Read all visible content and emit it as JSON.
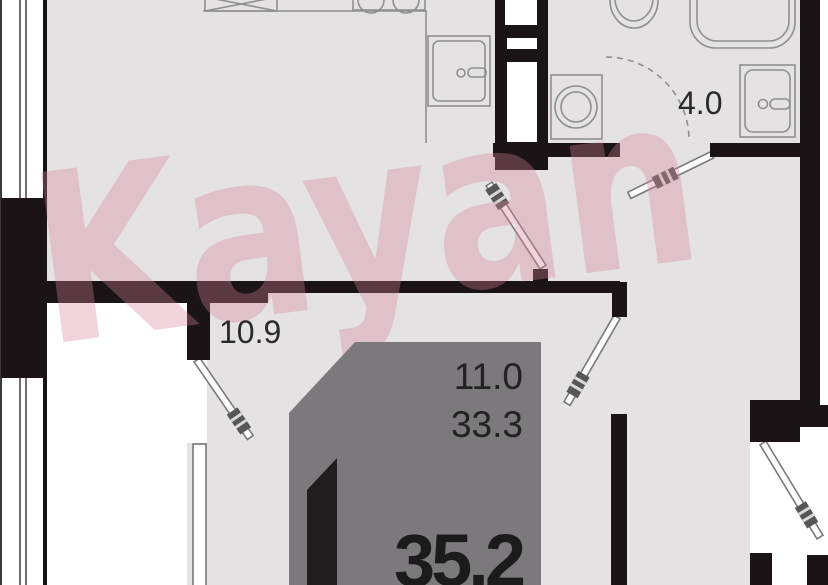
{
  "plan": {
    "type": "apartment-floor-plan",
    "watermark": {
      "text": "Kayan",
      "color": "#d8829c"
    },
    "labels": {
      "bathroom_area": "4.0",
      "hallway_area": "10.9",
      "room_area": "11.0",
      "living_total_area": "33.3",
      "total_area": "35.2"
    },
    "colors": {
      "floor": "#e4e2e2",
      "wall": "#1a1416",
      "outside": "#ffffff",
      "logo_polygon": "#7b797b",
      "logo_flag": "#201d1e",
      "fixture_outline": "#8f8f8f",
      "label_text": "#2a2a2a"
    }
  }
}
